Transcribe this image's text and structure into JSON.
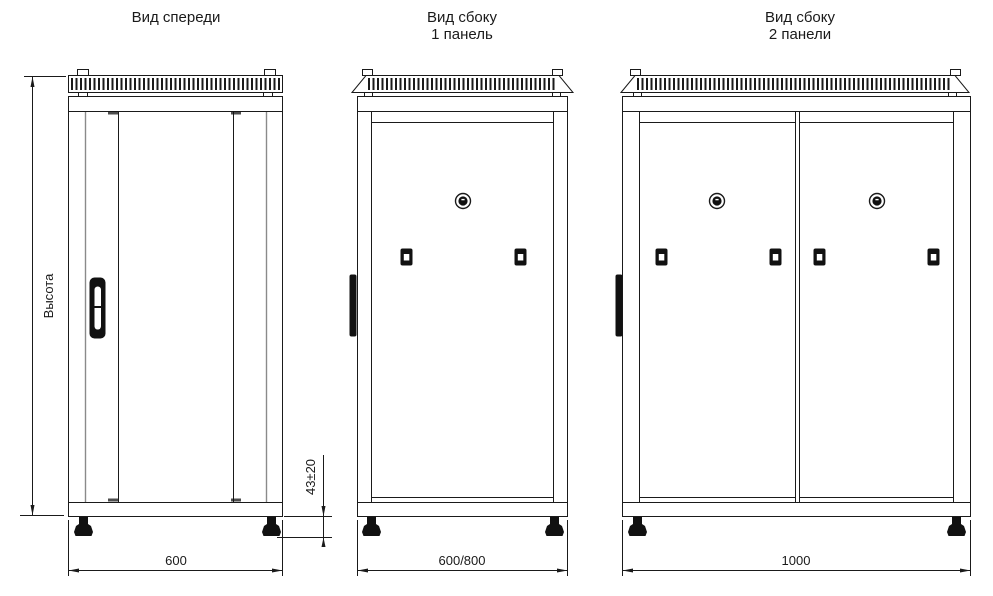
{
  "drawing": {
    "type": "technical-drawing",
    "subject": "server cabinet views",
    "views": {
      "front": {
        "title": "Вид спереди"
      },
      "side1": {
        "title_line1": "Вид сбоку",
        "title_line2": "1 панель"
      },
      "side2": {
        "title_line1": "Вид сбоку",
        "title_line2": "2 панели"
      }
    },
    "dimensions": {
      "height_label": "Высота",
      "front_width": "600",
      "feet_height": "43±20",
      "side1_depth": "600/800",
      "side2_depth": "1000"
    },
    "features": {
      "front": [
        "ventilation-grille",
        "glass-door",
        "door-handle",
        "leveling-feet"
      ],
      "side1": [
        "ventilation-grille",
        "side-panel",
        "round-lock",
        "two-latches",
        "leveling-feet"
      ],
      "side2": [
        "ventilation-grille",
        "two-side-panels",
        "two-round-locks",
        "four-latches",
        "leveling-feet"
      ]
    },
    "colors": {
      "line": "#1a1a1a",
      "secondary_line": "#8a8a8a",
      "background": "#ffffff"
    }
  }
}
